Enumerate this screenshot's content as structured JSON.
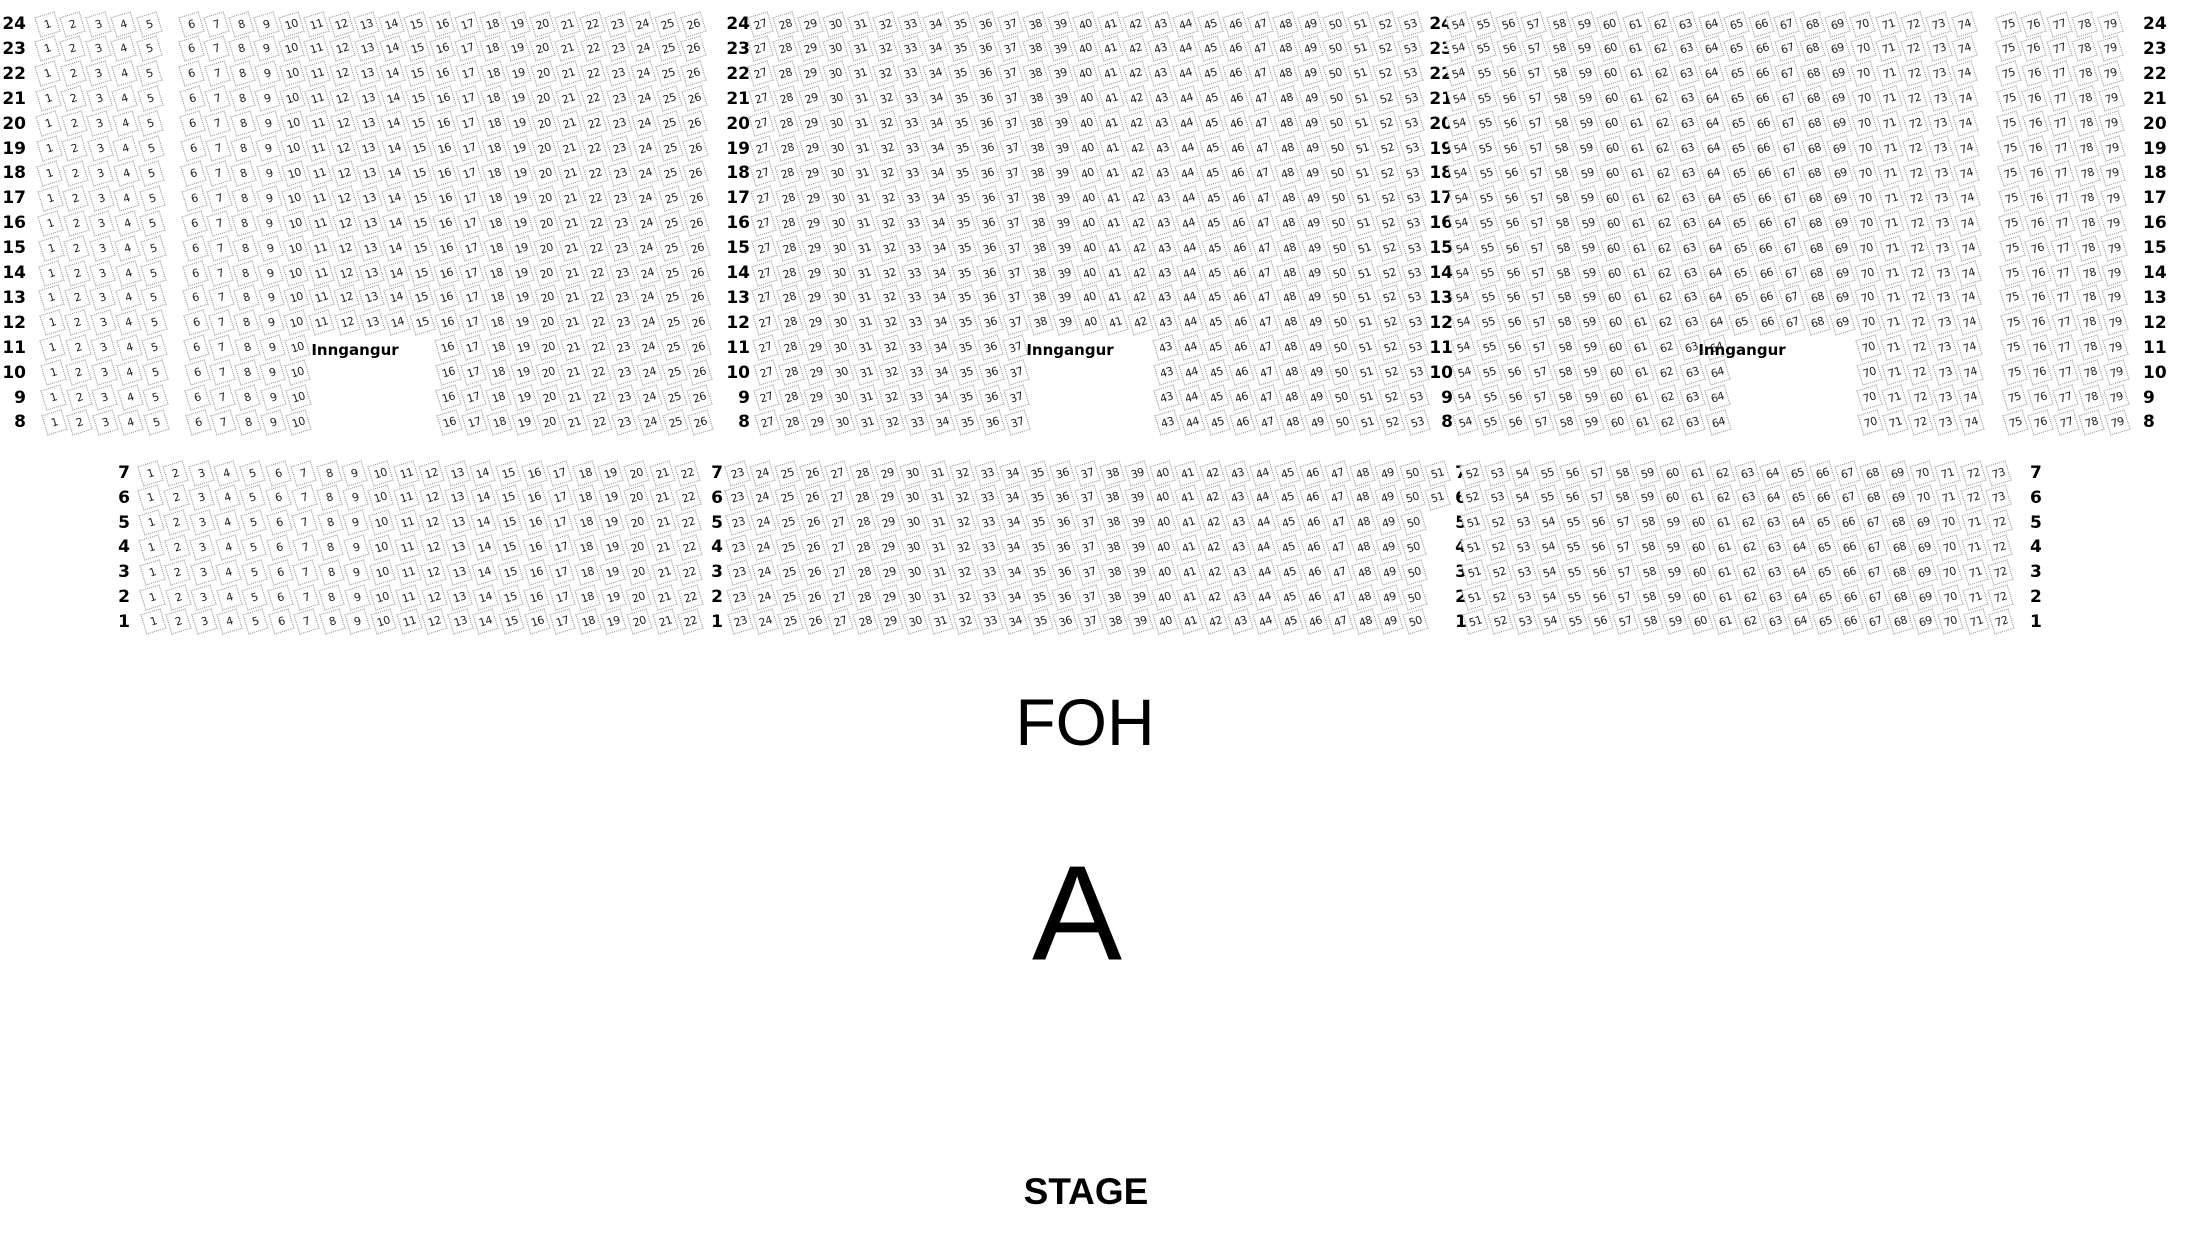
{
  "labels": {
    "entrance": "Inngangur",
    "foh": "FOH",
    "section": "A",
    "stage": "STAGE"
  },
  "colors": {
    "background": "#ffffff",
    "seat_border": "#8f8f8f",
    "seat_number": "#1f1f1f",
    "text": "#000000"
  },
  "seat_map": {
    "upper": {
      "row_from": 24,
      "row_to": 8,
      "entrance_rows": [
        11,
        10,
        9,
        8
      ],
      "blocks": [
        {
          "from": 1,
          "to": 5
        },
        {
          "from": 6,
          "to": 26,
          "gap_from": 11,
          "gap_to": 15
        },
        {
          "from": 27,
          "to": 53,
          "gap_from": 38,
          "gap_to": 42
        },
        {
          "from": 54,
          "to": 74,
          "gap_from": 65,
          "gap_to": 69
        },
        {
          "from": 75,
          "to": 79
        }
      ]
    },
    "lower": {
      "row_from": 7,
      "row_to": 1,
      "blocks": [
        {
          "from": 1,
          "to": 22
        },
        {
          "from": 23,
          "to": 50,
          "overrides": {
            "7": [
              23,
              51
            ],
            "6": [
              23,
              51
            ]
          }
        },
        {
          "from": 51,
          "to": 72,
          "overrides": {
            "7": [
              52,
              73
            ],
            "6": [
              52,
              73
            ]
          }
        }
      ]
    }
  }
}
